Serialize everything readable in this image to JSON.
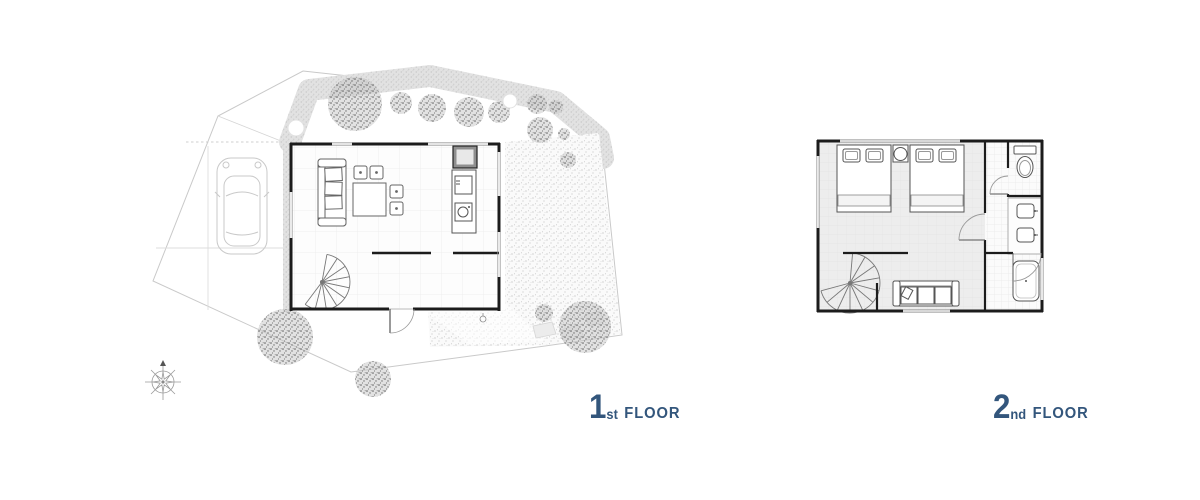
{
  "canvas": {
    "width": 1200,
    "height": 500,
    "background": "#ffffff"
  },
  "colors": {
    "accent_blue": "#33567C",
    "wall": "#1c1c1c",
    "furniture_line": "#5a5a5a",
    "site_line": "#c9c9c9",
    "tree_gray": "#8c8c8c",
    "bedroom_floor_tint": "#ededed"
  },
  "labels": {
    "floor1": {
      "number": "1",
      "ordinal": "st",
      "word": "FLOOR"
    },
    "floor2": {
      "number": "2",
      "ordinal": "nd",
      "word": "FLOOR"
    }
  },
  "plan1": {
    "title": "site plan with first floor",
    "elements": [
      "site-boundary",
      "hedge",
      "gravel-yard",
      "stepping-stones",
      "trees",
      "driveway",
      "car",
      "living-room",
      "sofa",
      "coffee-table",
      "stools",
      "kitchen-counter",
      "stove",
      "kitchen-sink",
      "refrigerator",
      "spiral-staircase",
      "entrance-door",
      "path-light",
      "compass-rose"
    ]
  },
  "plan2": {
    "title": "second floor plan",
    "elements": [
      "bedroom",
      "bed-left",
      "bed-right",
      "nightstand",
      "table-lamp",
      "sofa",
      "spiral-staircase",
      "bathroom",
      "toilet",
      "vanity-sinks",
      "bathtub",
      "interior-doors"
    ]
  }
}
